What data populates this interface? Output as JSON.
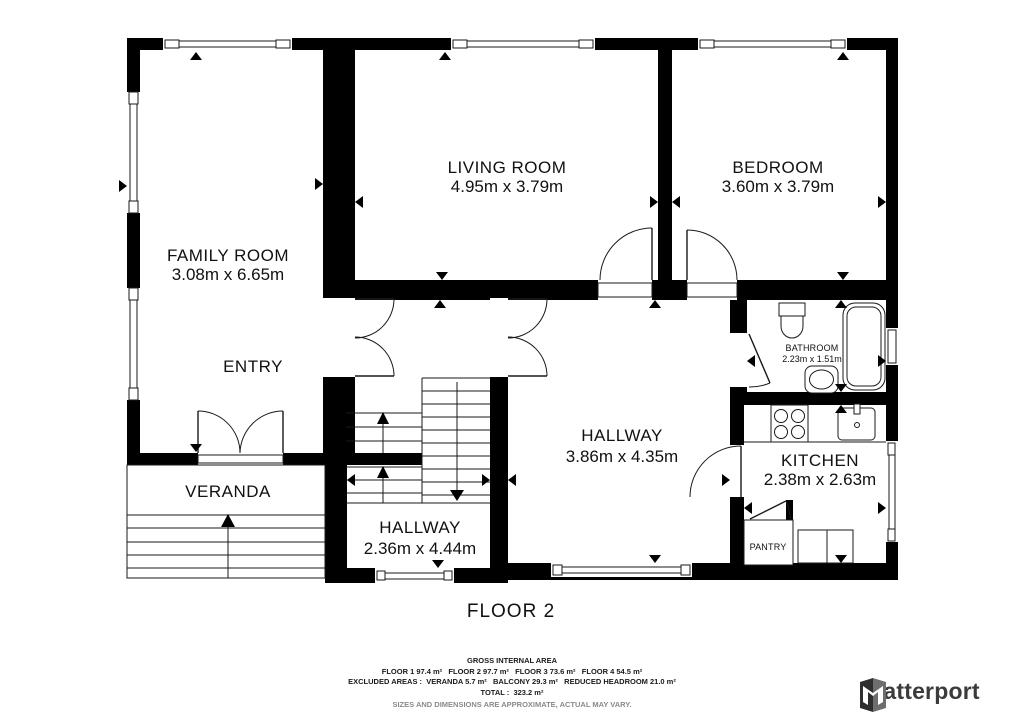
{
  "floor_label": "FLOOR 2",
  "rooms": {
    "family_room": {
      "name": "FAMILY ROOM",
      "dims": "3.08m x 6.65m"
    },
    "entry": {
      "name": "ENTRY"
    },
    "veranda": {
      "name": "VERANDA"
    },
    "living_room": {
      "name": "LIVING ROOM",
      "dims": "4.95m x 3.79m"
    },
    "bedroom": {
      "name": "BEDROOM",
      "dims": "3.60m x 3.79m"
    },
    "hallway_main": {
      "name": "HALLWAY",
      "dims": "3.86m x 4.35m"
    },
    "hallway_lower": {
      "name": "HALLWAY",
      "dims": "2.36m x 4.44m"
    },
    "bathroom": {
      "name": "BATHROOM",
      "dims": "2.23m x 1.51m"
    },
    "kitchen": {
      "name": "KITCHEN",
      "dims": "2.38m x 2.63m"
    },
    "pantry": {
      "name": "PANTRY"
    }
  },
  "footer": {
    "gross_title": "GROSS INTERNAL AREA",
    "line_floors": "FLOOR 1 97.4 m²   FLOOR 2 97.7 m²   FLOOR 3 73.6 m²   FLOOR 4 54.5 m²",
    "line_excluded": "EXCLUDED AREAS :  VERANDA 5.7 m²   BALCONY 29.3 m²   REDUCED HEADROOM 21.0 m²",
    "line_total": "TOTAL :  323.2 m²",
    "disclaimer": "SIZES AND DIMENSIONS ARE APPROXIMATE, ACTUAL MAY VARY."
  },
  "branding": {
    "logo_text": "Matterport"
  },
  "colors": {
    "wall": "#000000",
    "background": "#ffffff",
    "text": "#1a1a1a",
    "disclaimer": "#8a8a8a"
  }
}
